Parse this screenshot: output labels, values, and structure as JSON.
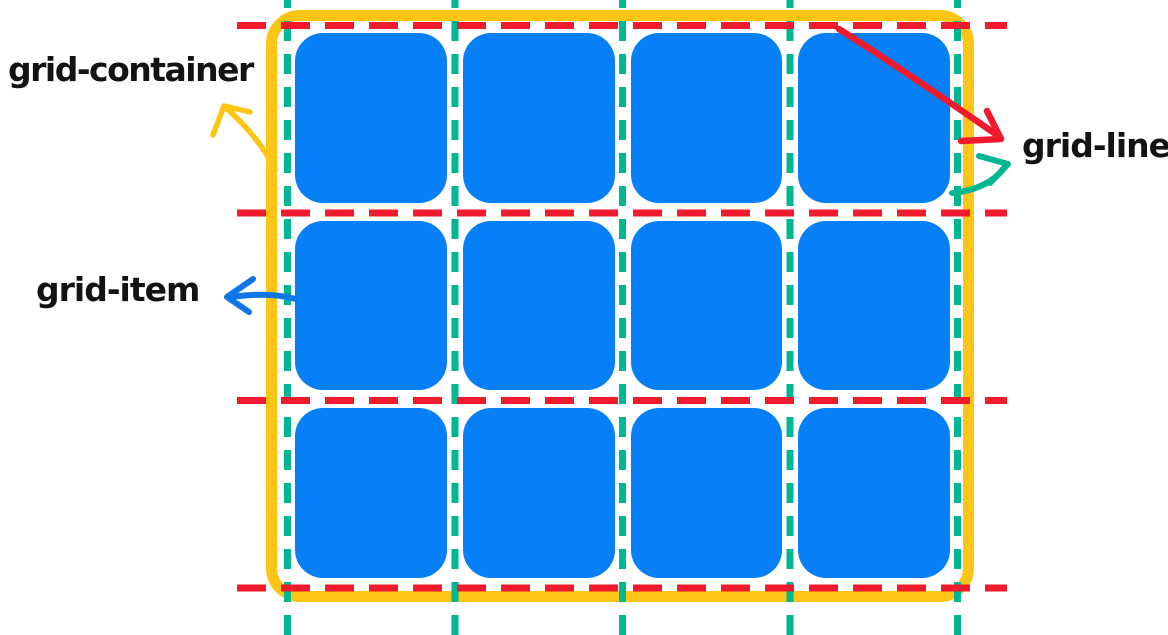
{
  "labels": {
    "container": "grid-container",
    "item": "grid-item",
    "line": "grid-line"
  },
  "grid": {
    "columns": 4,
    "rows": 3,
    "item_count": 12,
    "row_line_count": 4,
    "column_line_count": 5
  },
  "colors": {
    "item_blue": "#067ff7",
    "container_yellow": "#fdc515",
    "row_line_red": "#ef1a2b",
    "column_line_teal": "#01b693",
    "item_arrow_blue": "#0d76e8",
    "label_ink": "#131313",
    "background": "#ffffff"
  },
  "arrows": [
    {
      "name": "container-arrow",
      "color": "#fdc515",
      "points_to": "grid-container"
    },
    {
      "name": "item-arrow",
      "color": "#0d76e8",
      "points_to": "grid-item"
    },
    {
      "name": "line-arrow-red",
      "color": "#ef1a2b",
      "points_to": "grid-line"
    },
    {
      "name": "line-arrow-teal",
      "color": "#01b693",
      "points_to": "grid-line"
    }
  ]
}
